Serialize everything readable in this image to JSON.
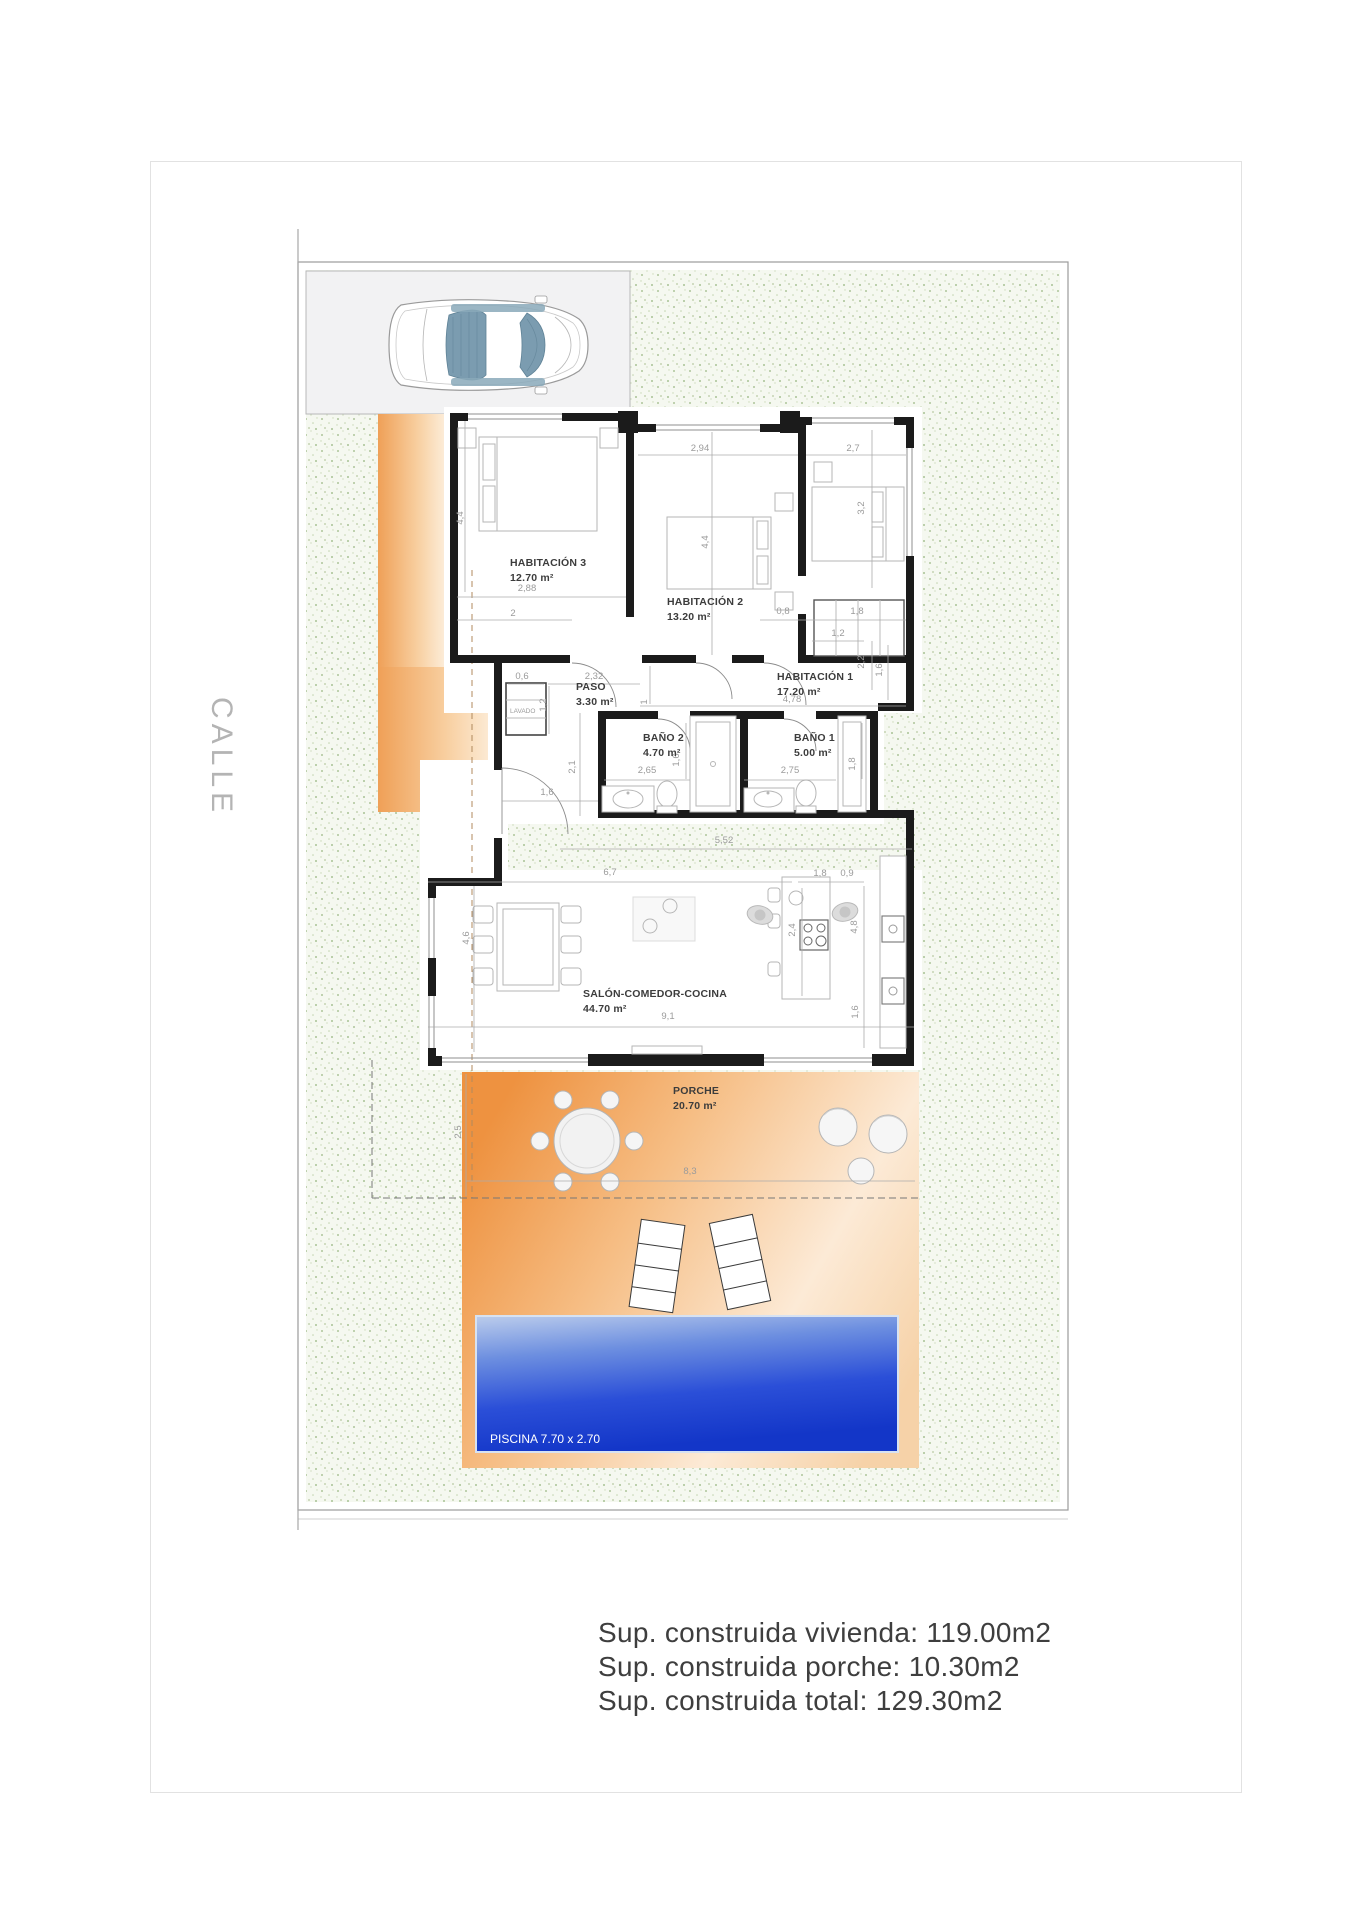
{
  "street": {
    "label": "CALLE"
  },
  "rooms": {
    "hab3": {
      "name": "HABITACIÓN 3",
      "area": "12.70 m²"
    },
    "hab2": {
      "name": "HABITACIÓN 2",
      "area": "13.20 m²"
    },
    "hab1": {
      "name": "HABITACIÓN 1",
      "area": "17.20 m²"
    },
    "paso": {
      "name": "PASO",
      "area": "3.30 m²"
    },
    "lavado": {
      "name": "LAVADO"
    },
    "bano2": {
      "name": "BAÑO 2",
      "area": "4.70 m²"
    },
    "bano1": {
      "name": "BAÑO 1",
      "area": "5.00 m²"
    },
    "salon": {
      "name": "SALÓN-COMEDOR-COCINA",
      "area": "44.70 m²"
    },
    "porche": {
      "name": "PORCHE",
      "area": "20.70 m²"
    },
    "piscina": {
      "label": "PISCINA 7.70 x 2.70"
    }
  },
  "dims": [
    "4,4",
    "2,88",
    "2",
    "2,94",
    "4,4",
    "2,7",
    "3,2",
    "0,8",
    "1,8",
    "1,2",
    "2,2",
    "1,6",
    "4,78",
    "2,32",
    "0,6",
    "1,2",
    "1",
    "2,1",
    "1,6",
    "2,65",
    "1,6",
    "2,75",
    "1,8",
    "5,52",
    "6,7",
    "1,8",
    "0,9",
    "2,4",
    "4,8",
    "4,6",
    "9,1",
    "1,6",
    "2,5",
    "8,3"
  ],
  "summary": {
    "vivienda": "Sup. construida vivienda: 119.00m2",
    "porche": "Sup. construida porche: 10.30m2",
    "total": "Sup. construida total: 129.30m2"
  },
  "colors": {
    "terrace_orange": "#f09c4a",
    "pool_blue": "#2b4fd8",
    "garden_dot_green": "#aec59a",
    "parking_gray": "#f2f2f3",
    "wall_black": "#1b1b1b"
  }
}
